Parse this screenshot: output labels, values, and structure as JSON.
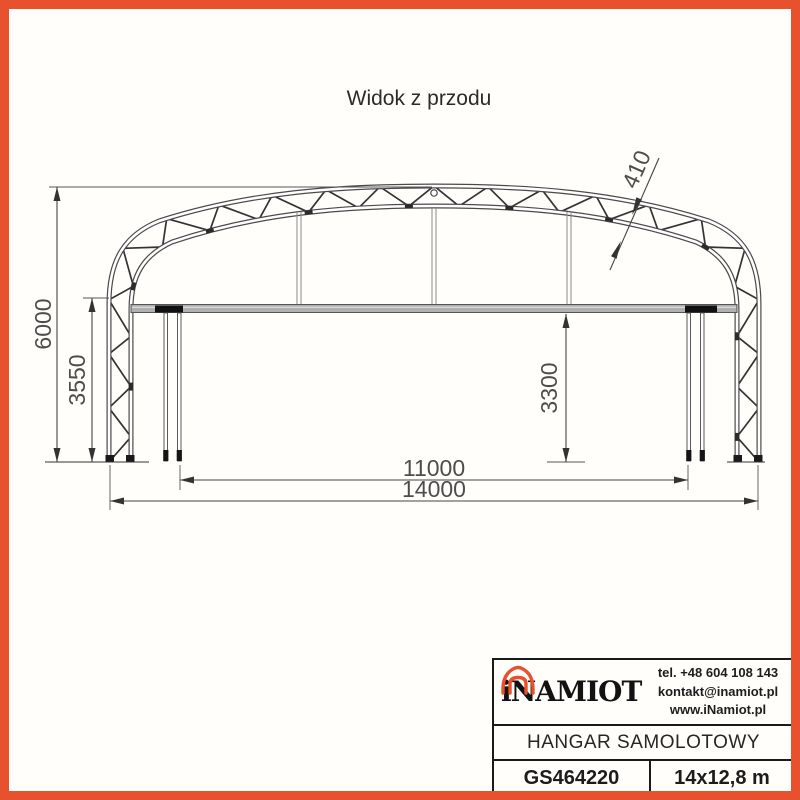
{
  "page": {
    "title": "Widok z przodu"
  },
  "drawing": {
    "dim_total_height": "6000",
    "dim_side_height": "3550",
    "dim_clear_height": "3300",
    "dim_inner_width": "11000",
    "dim_outer_width": "14000",
    "dim_truss_depth": "410"
  },
  "title_block": {
    "brand": "iNAMIOT",
    "phone": "tel. +48 604 108 143",
    "email": "kontakt@inamiot.pl",
    "website": "www.iNamiot.pl",
    "product_name": "HANGAR SAMOLOTOWY",
    "model_code": "GS464220",
    "dimensions_label": "14x12,8 m"
  },
  "colors": {
    "frame": "#E8512D",
    "logo_accent": "#E8512D"
  }
}
